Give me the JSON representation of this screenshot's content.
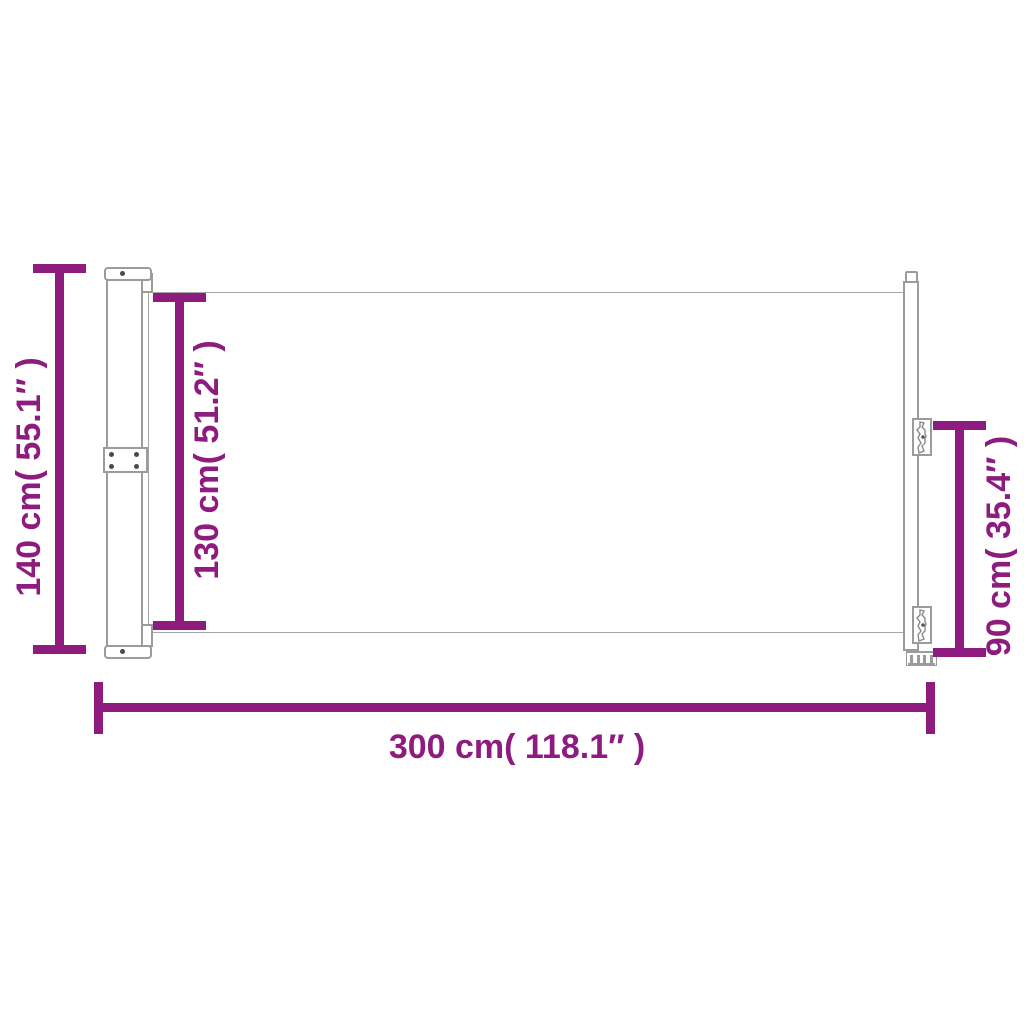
{
  "diagram": {
    "type": "product-dimension-diagram",
    "subject": "retractable side awning with cassette post, fabric screen and pull-out pole",
    "background_color": "#ffffff",
    "accent_color": "#8E1C7E",
    "outline_color": "#9b9b9b"
  },
  "dimensions": {
    "overall_height": {
      "cm": "140",
      "inches": "55.1",
      "label": "140 cm( 55.1″ )"
    },
    "fabric_height": {
      "cm": "130",
      "inches": "51.2",
      "label": "130 cm( 51.2″ )"
    },
    "pole_height": {
      "cm": "90",
      "inches": "35.4",
      "label": "90 cm( 35.4″ )"
    },
    "overall_width": {
      "cm": "300",
      "inches": "118.1",
      "label": "300 cm( 118.1″ )"
    }
  }
}
